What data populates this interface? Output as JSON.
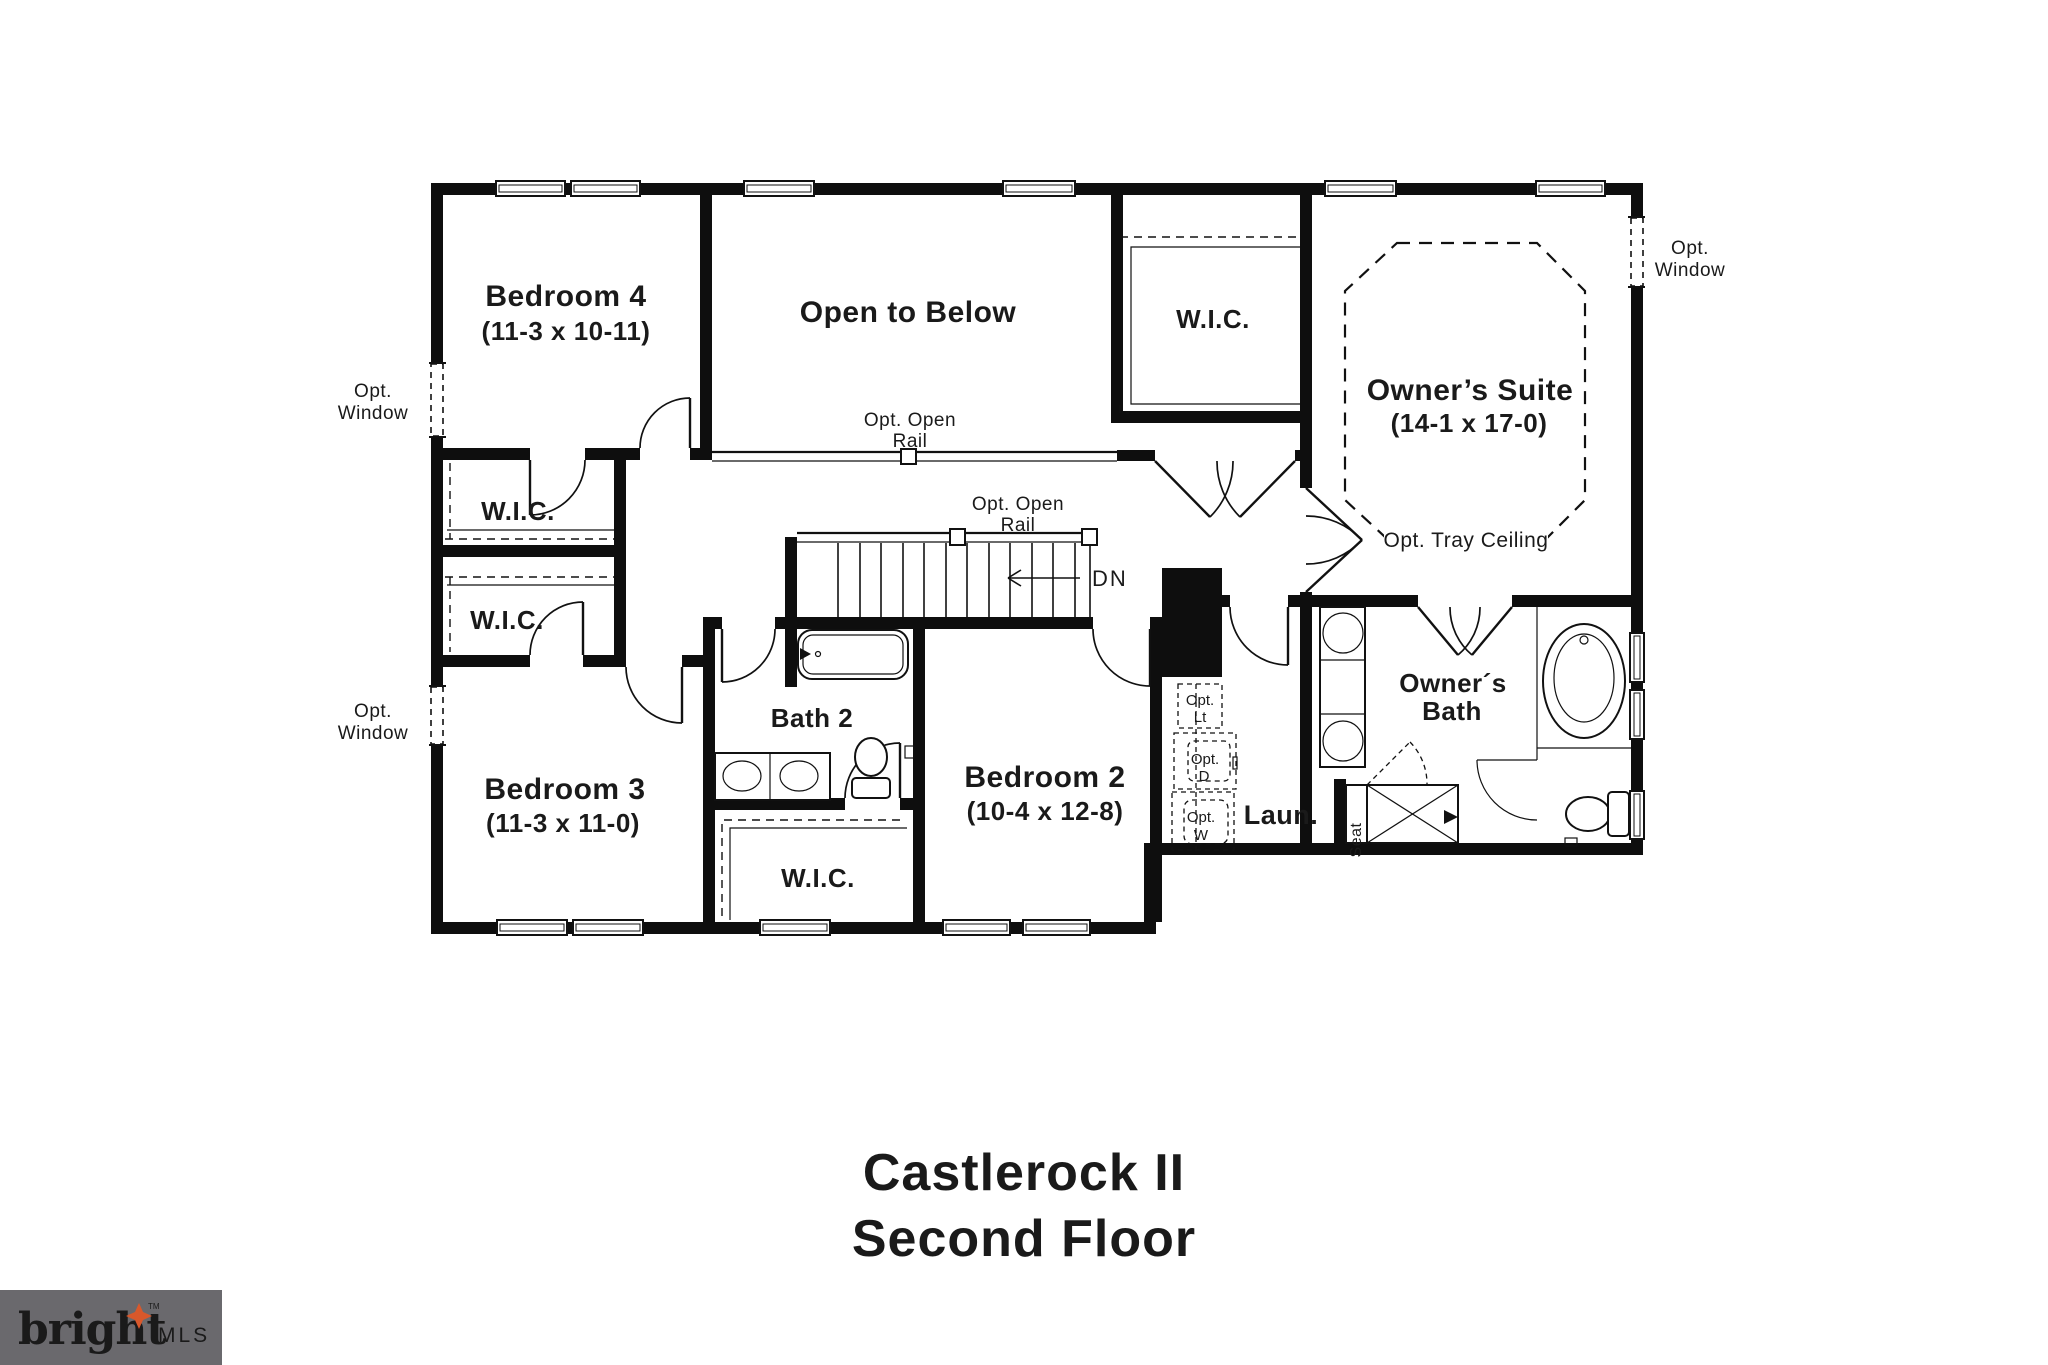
{
  "title": {
    "line1": "Castlerock II",
    "line2": "Second Floor"
  },
  "logo": {
    "brand": "bright",
    "tm": "TM",
    "suffix": "MLS",
    "bg": "#6a696d",
    "star": "#d9582b",
    "brand_color": "#f1eee8",
    "suffix_color": "#bdbcc0"
  },
  "colors": {
    "wall": "#0e0e0e",
    "line": "#1a1a1a"
  },
  "rooms": {
    "bedroom4": {
      "name": "Bedroom 4",
      "dims": "(11-3 x 10-11)"
    },
    "open_to_below": {
      "name": "Open to Below"
    },
    "wic": {
      "name": "W.I.C."
    },
    "owners_suite": {
      "name": "Owner’s Suite",
      "dims": "(14-1 x 17-0)"
    },
    "bedroom3": {
      "name": "Bedroom 3",
      "dims": "(11-3 x 11-0)"
    },
    "bath2": {
      "name": "Bath 2"
    },
    "bedroom2": {
      "name": "Bedroom 2",
      "dims": "(10-4 x 12-8)"
    },
    "laundry": {
      "name": "Laun."
    },
    "owners_bath": {
      "line1": "Owner´s",
      "line2": "Bath"
    }
  },
  "annotations": {
    "opt": "Opt.",
    "window": "Window",
    "open_rail_line1": "Opt. Open",
    "open_rail_line2": "Rail",
    "tray_ceiling": "Opt. Tray Ceiling",
    "dn": "DN",
    "seat": "Seat",
    "lt": "Lt",
    "d": "D",
    "w": "W"
  }
}
